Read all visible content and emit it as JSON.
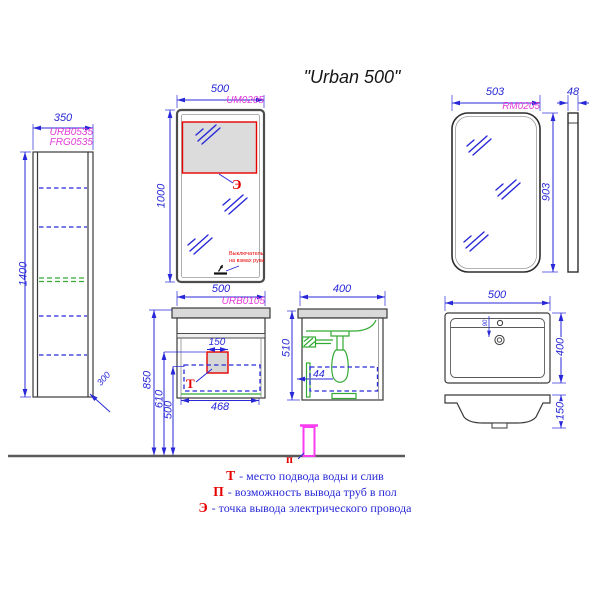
{
  "title": "\"Urban 500\"",
  "colors": {
    "dimension_blue": "#2828d8",
    "code_magenta": "#e23ad6",
    "marker_red": "#e60000",
    "pipe_pink": "#fa3cf0",
    "hidden_green": "#33aa33",
    "outline_dark": "#3a3a3a",
    "panel_gray": "#d9d9d9"
  },
  "tall_cabinet": {
    "width": "350",
    "height": "1400",
    "depth": "300",
    "code1": "URB0535",
    "code2": "FRG0535"
  },
  "mirror_um": {
    "code": "UM0205",
    "width": "500",
    "height": "1000",
    "power_marker": "Э",
    "sensor_note_1": "Выключатель",
    "sensor_note_2": "на взмах руки"
  },
  "mirror_rm": {
    "code": "RM0205",
    "width": "503",
    "height": "903",
    "depth": "48"
  },
  "vanity": {
    "code": "URB0105",
    "width": "500",
    "inner_width": "468",
    "access_size": "150",
    "height_total": "850",
    "height_drain": "610",
    "height_shelf": "500",
    "water_marker": "Т"
  },
  "side_view": {
    "width": "400",
    "height": "510",
    "offset": "44",
    "floor_marker": "п"
  },
  "sink_top": {
    "width": "500",
    "depth": "400",
    "hole_offset": "90"
  },
  "sink_profile": {
    "height": "150"
  },
  "legend": [
    {
      "marker": "Т",
      "text": "- место подвода воды и слив"
    },
    {
      "marker": "П",
      "text": "- возможность вывода труб в пол"
    },
    {
      "marker": "Э",
      "text": "- точка вывода электрического провода"
    }
  ]
}
